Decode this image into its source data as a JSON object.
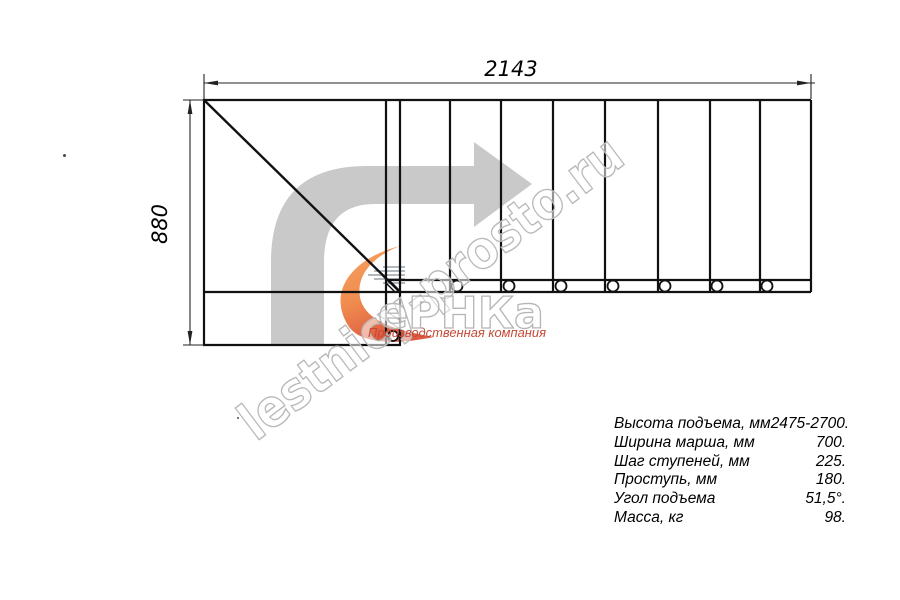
{
  "drawing": {
    "title": "Поэтажный план лестницы (вид сверху)",
    "width_dimension_label": "2143",
    "height_dimension_label": "880"
  },
  "watermark": {
    "site_text": "lestnicy-prosto.ru",
    "logo_text": "еРНКа",
    "logo_subtitle": "Производственная компания"
  },
  "specs": {
    "rows": [
      {
        "label": "Высота подъема, мм",
        "value": "2475-2700."
      },
      {
        "label": "Ширина марша, мм",
        "value": "700."
      },
      {
        "label": "Шаг ступеней, мм",
        "value": "225."
      },
      {
        "label": "Проступь, мм",
        "value": "180."
      },
      {
        "label": "Угол подъема",
        "value": "51,5°."
      },
      {
        "label": "Масса, кг",
        "value": "98."
      }
    ]
  },
  "colors": {
    "drawing_line": "#111111",
    "dimension_line": "#222222",
    "watermark_grey": "#c9c9c9",
    "watermark_stroke_grey": "#b5b5b5",
    "logo_orange": "#ef7f3c",
    "logo_orange_deep": "#d9472b",
    "logo_subtitle_red": "#c44a36",
    "speed_lines_grey": "#97a0a8"
  }
}
